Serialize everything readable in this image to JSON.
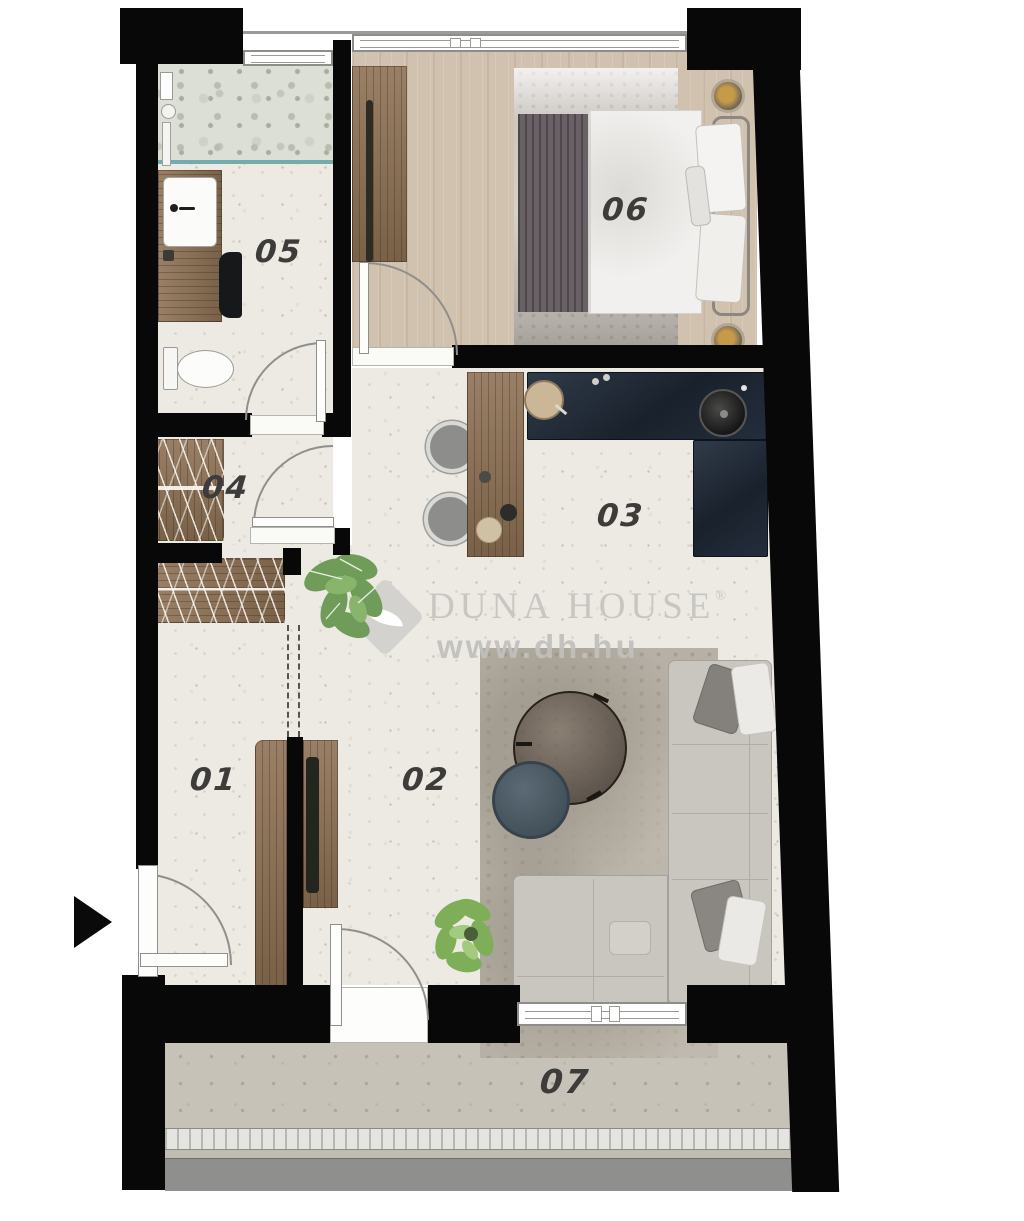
{
  "plan": {
    "title": "apartment-floor-plan",
    "rooms": [
      {
        "label": "01"
      },
      {
        "label": "02"
      },
      {
        "label": "03"
      },
      {
        "label": "04"
      },
      {
        "label": "05"
      },
      {
        "label": "06"
      },
      {
        "label": "07"
      }
    ]
  },
  "watermark": {
    "brand": "Duna House",
    "reg": "®",
    "url": "www.dh.hu"
  },
  "colors": {
    "wall": "#080808",
    "floor_cream": "#edeae3",
    "floor_wood": "#d1c2af",
    "wood_dark": "#8d7154",
    "kitchen_counter": "#222c38",
    "shower_glass": "#74acae",
    "balcony_floor": "#c6c2b8",
    "balcony_edge": "#8f8f8d",
    "rug": "#b6b0a6",
    "sofa": "#c9c5bf",
    "label_text": "#3d3c3a",
    "watermark_gray": "#c7c6c3"
  }
}
